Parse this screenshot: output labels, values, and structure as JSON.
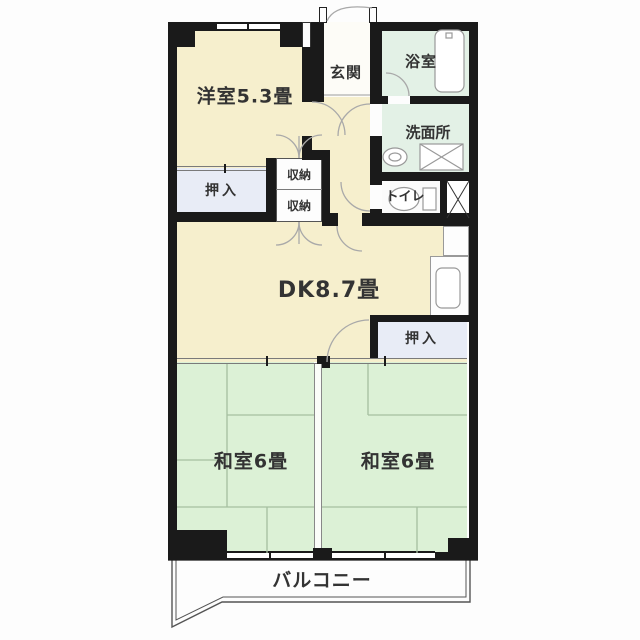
{
  "floorplan": {
    "labels": {
      "western_room": "洋室5.3畳",
      "entrance": "玄関",
      "bathroom": "浴室",
      "washroom": "洗面所",
      "toilet": "トイレ",
      "closet_left": "押入",
      "storage_top": "収納",
      "storage_bottom": "収納",
      "dining_kitchen": "DK8.7畳",
      "closet_right": "押入",
      "japanese_room_left": "和室6畳",
      "japanese_room_right": "和室6畳",
      "balcony": "バルコニー"
    },
    "colors": {
      "wall": "#1a1a1a",
      "cream_room": "#f6efcd",
      "mint_room": "#e3f1e6",
      "tatami_green": "#dcf1d6",
      "closet_blue": "#e8ecf6",
      "entrance_white": "#fdfcf7",
      "tatami_line": "#a5bfa0",
      "door_arc": "#a9a9a9",
      "label_text": "#333333"
    }
  }
}
